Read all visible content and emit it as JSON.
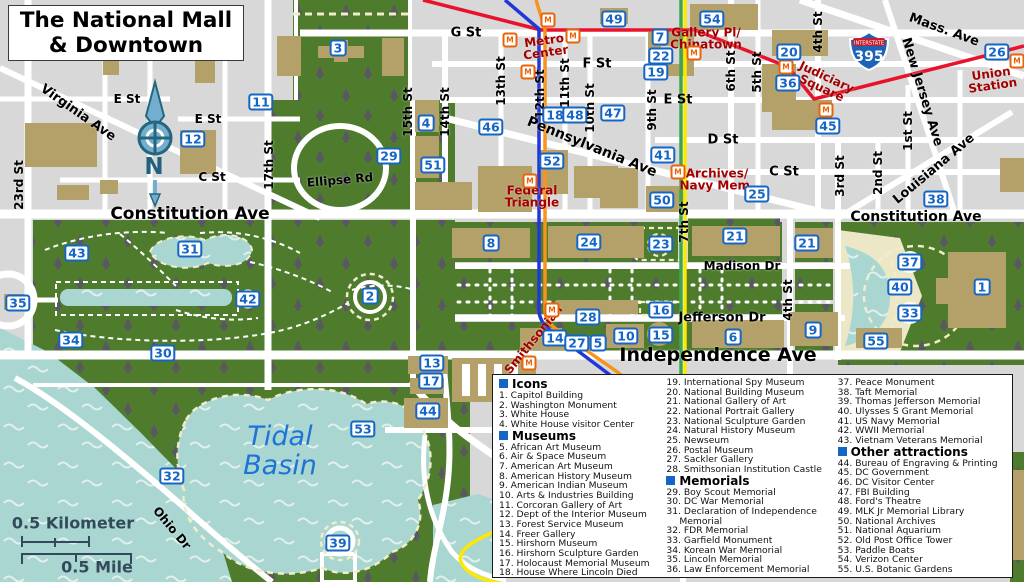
{
  "title": {
    "line1": "The National Mall",
    "line2": "& Downtown"
  },
  "scale": {
    "km": "0.5 Kilometer",
    "mile": "0.5 Mile"
  },
  "interstate": {
    "label": "INTERSTATE",
    "number": "395"
  },
  "compass": {
    "n": "N"
  },
  "colors": {
    "park_green": "#4e7c2c",
    "water": "#a9d6d1",
    "building_tan": "#b3a169",
    "road": "#ffffff",
    "block_gray": "#d8d8d8",
    "plaza_cream": "#ece7c6",
    "marker_blue": "#1565c5",
    "station_red": "#a30000",
    "water_label_blue": "#1b74d6",
    "metro_red": "#e8132b",
    "metro_orange": "#f7941d",
    "metro_blue": "#2138d8",
    "metro_green": "#3aa655",
    "metro_yellow": "#ffe800",
    "scale_slate": "#33495c"
  },
  "map": {
    "water_label": {
      "lines": [
        "Tidal",
        "Basin"
      ]
    },
    "metro_icon_glyph": "M",
    "markers": [
      {
        "n": "1",
        "x": 982,
        "y": 287
      },
      {
        "n": "2",
        "x": 370,
        "y": 296
      },
      {
        "n": "3",
        "x": 338,
        "y": 48
      },
      {
        "n": "4",
        "x": 426,
        "y": 123
      },
      {
        "n": "5",
        "x": 598,
        "y": 343
      },
      {
        "n": "6",
        "x": 733,
        "y": 337
      },
      {
        "n": "7",
        "x": 660,
        "y": 37
      },
      {
        "n": "8",
        "x": 491,
        "y": 243
      },
      {
        "n": "9",
        "x": 813,
        "y": 330
      },
      {
        "n": "10",
        "x": 626,
        "y": 336
      },
      {
        "n": "11",
        "x": 261,
        "y": 102
      },
      {
        "n": "12",
        "x": 193,
        "y": 139
      },
      {
        "n": "13",
        "x": 432,
        "y": 363
      },
      {
        "n": "14",
        "x": 555,
        "y": 338
      },
      {
        "n": "15",
        "x": 661,
        "y": 335
      },
      {
        "n": "16",
        "x": 661,
        "y": 310
      },
      {
        "n": "17",
        "x": 431,
        "y": 381
      },
      {
        "n": "18",
        "x": 555,
        "y": 115
      },
      {
        "n": "19",
        "x": 656,
        "y": 72
      },
      {
        "n": "20",
        "x": 789,
        "y": 52
      },
      {
        "n": "21",
        "x": 735,
        "y": 236
      },
      {
        "n": "21",
        "x": 807,
        "y": 243
      },
      {
        "n": "22",
        "x": 661,
        "y": 56
      },
      {
        "n": "23",
        "x": 661,
        "y": 244
      },
      {
        "n": "24",
        "x": 589,
        "y": 242
      },
      {
        "n": "25",
        "x": 757,
        "y": 194
      },
      {
        "n": "26",
        "x": 997,
        "y": 52
      },
      {
        "n": "27",
        "x": 577,
        "y": 343
      },
      {
        "n": "28",
        "x": 588,
        "y": 317
      },
      {
        "n": "29",
        "x": 389,
        "y": 156
      },
      {
        "n": "30",
        "x": 163,
        "y": 353
      },
      {
        "n": "31",
        "x": 190,
        "y": 249
      },
      {
        "n": "32",
        "x": 172,
        "y": 476
      },
      {
        "n": "33",
        "x": 910,
        "y": 313
      },
      {
        "n": "34",
        "x": 71,
        "y": 340
      },
      {
        "n": "35",
        "x": 18,
        "y": 303
      },
      {
        "n": "36",
        "x": 788,
        "y": 83
      },
      {
        "n": "37",
        "x": 910,
        "y": 262
      },
      {
        "n": "38",
        "x": 936,
        "y": 199
      },
      {
        "n": "39",
        "x": 338,
        "y": 543
      },
      {
        "n": "40",
        "x": 900,
        "y": 287
      },
      {
        "n": "41",
        "x": 663,
        "y": 155
      },
      {
        "n": "42",
        "x": 248,
        "y": 299
      },
      {
        "n": "43",
        "x": 77,
        "y": 253
      },
      {
        "n": "44",
        "x": 428,
        "y": 411
      },
      {
        "n": "45",
        "x": 828,
        "y": 126
      },
      {
        "n": "46",
        "x": 491,
        "y": 127
      },
      {
        "n": "47",
        "x": 613,
        "y": 113
      },
      {
        "n": "48",
        "x": 575,
        "y": 115
      },
      {
        "n": "49",
        "x": 614,
        "y": 19
      },
      {
        "n": "50",
        "x": 662,
        "y": 200
      },
      {
        "n": "51",
        "x": 433,
        "y": 165
      },
      {
        "n": "52",
        "x": 552,
        "y": 161
      },
      {
        "n": "53",
        "x": 363,
        "y": 429
      },
      {
        "n": "54",
        "x": 712,
        "y": 19
      },
      {
        "n": "55",
        "x": 876,
        "y": 341
      }
    ],
    "street_labels": [
      {
        "t": "G St",
        "x": 466,
        "y": 33,
        "r": 0,
        "s": 13
      },
      {
        "t": "F St",
        "x": 597,
        "y": 64,
        "r": 0,
        "s": 13
      },
      {
        "t": "E St",
        "x": 678,
        "y": 100,
        "r": 0,
        "s": 13
      },
      {
        "t": "D St",
        "x": 723,
        "y": 140,
        "r": 0,
        "s": 13
      },
      {
        "t": "C St",
        "x": 784,
        "y": 172,
        "r": 0,
        "s": 13
      },
      {
        "t": "E St",
        "x": 127,
        "y": 99,
        "r": 0,
        "s": 12
      },
      {
        "t": "E St",
        "x": 208,
        "y": 119,
        "r": 0,
        "s": 12
      },
      {
        "t": "C St",
        "x": 212,
        "y": 177,
        "r": 0,
        "s": 12
      },
      {
        "t": "Constitution Ave",
        "x": 190,
        "y": 214,
        "r": 0,
        "s": 17
      },
      {
        "t": "Constitution Ave",
        "x": 916,
        "y": 217,
        "r": 0,
        "s": 14
      },
      {
        "t": "Madison Dr",
        "x": 742,
        "y": 266,
        "r": 0,
        "s": 12
      },
      {
        "t": "Jefferson Dr",
        "x": 722,
        "y": 318,
        "r": 0,
        "s": 13
      },
      {
        "t": "Independence Ave",
        "x": 718,
        "y": 355,
        "r": 0,
        "s": 19
      },
      {
        "t": "Pennsylvania Ave",
        "x": 592,
        "y": 147,
        "r": 22,
        "s": 14
      },
      {
        "t": "Virginia Ave",
        "x": 78,
        "y": 113,
        "r": 35,
        "s": 13
      },
      {
        "t": "Mass. Ave",
        "x": 944,
        "y": 30,
        "r": 20,
        "s": 13
      },
      {
        "t": "New Jersey Ave",
        "x": 922,
        "y": 92,
        "r": 73,
        "s": 13
      },
      {
        "t": "Louisiana Ave",
        "x": 934,
        "y": 169,
        "r": -40,
        "s": 13
      },
      {
        "t": "1st St",
        "x": 908,
        "y": 131,
        "r": -90,
        "s": 12
      },
      {
        "t": "2nd St",
        "x": 878,
        "y": 173,
        "r": -90,
        "s": 12
      },
      {
        "t": "3rd St",
        "x": 840,
        "y": 176,
        "r": -90,
        "s": 12
      },
      {
        "t": "4th St",
        "x": 818,
        "y": 32,
        "r": -90,
        "s": 12
      },
      {
        "t": "5th St",
        "x": 757,
        "y": 72,
        "r": -90,
        "s": 12
      },
      {
        "t": "6th St",
        "x": 731,
        "y": 71,
        "r": -90,
        "s": 12
      },
      {
        "t": "7th St",
        "x": 684,
        "y": 222,
        "r": -90,
        "s": 12
      },
      {
        "t": "9th St",
        "x": 652,
        "y": 110,
        "r": -90,
        "s": 12
      },
      {
        "t": "10th St",
        "x": 590,
        "y": 108,
        "r": -90,
        "s": 12
      },
      {
        "t": "11th St",
        "x": 565,
        "y": 83,
        "r": -90,
        "s": 12
      },
      {
        "t": "12th St",
        "x": 540,
        "y": 94,
        "r": -90,
        "s": 12
      },
      {
        "t": "13th St",
        "x": 501,
        "y": 81,
        "r": -90,
        "s": 12
      },
      {
        "t": "14th St",
        "x": 445,
        "y": 112,
        "r": -90,
        "s": 12
      },
      {
        "t": "15th St",
        "x": 408,
        "y": 112,
        "r": -90,
        "s": 12
      },
      {
        "t": "17th St",
        "x": 269,
        "y": 165,
        "r": -90,
        "s": 12
      },
      {
        "t": "23rd St",
        "x": 19,
        "y": 185,
        "r": -90,
        "s": 12
      },
      {
        "t": "4th St",
        "x": 788,
        "y": 300,
        "r": -90,
        "s": 12
      },
      {
        "t": "Ellipse Rd",
        "x": 340,
        "y": 180,
        "r": -5,
        "s": 12
      },
      {
        "t": "Ohio Dr",
        "x": 172,
        "y": 528,
        "r": 50,
        "s": 12
      }
    ],
    "station_labels": [
      {
        "lines": [
          "Metro",
          "Center"
        ],
        "x": 545,
        "y": 47,
        "r": -8
      },
      {
        "lines": [
          "Gallery Pl/",
          "Chinatown"
        ],
        "x": 706,
        "y": 39,
        "r": 0
      },
      {
        "lines": [
          "Judiciary",
          "Square"
        ],
        "x": 824,
        "y": 83,
        "r": 25
      },
      {
        "lines": [
          "Union",
          "Station"
        ],
        "x": 992,
        "y": 80,
        "r": -8
      },
      {
        "lines": [
          "Federal",
          "Triangle"
        ],
        "x": 532,
        "y": 197,
        "r": 0
      },
      {
        "lines": [
          "Archives/",
          "Navy Mem."
        ],
        "x": 717,
        "y": 180,
        "r": 0
      },
      {
        "lines": [
          "Smithsonian"
        ],
        "x": 534,
        "y": 340,
        "r": -51
      }
    ],
    "metro_icons": [
      {
        "x": 548,
        "y": 20
      },
      {
        "x": 510,
        "y": 40
      },
      {
        "x": 573,
        "y": 36
      },
      {
        "x": 528,
        "y": 72
      },
      {
        "x": 530,
        "y": 181
      },
      {
        "x": 694,
        "y": 53
      },
      {
        "x": 786,
        "y": 67
      },
      {
        "x": 826,
        "y": 110
      },
      {
        "x": 1017,
        "y": 61
      },
      {
        "x": 678,
        "y": 172
      },
      {
        "x": 552,
        "y": 310
      },
      {
        "x": 529,
        "y": 363
      }
    ]
  },
  "legend": {
    "columns": [
      [
        {
          "h": "Icons"
        },
        {
          "i": "1. Capitol Building"
        },
        {
          "i": "2. Washington Monument"
        },
        {
          "i": "3. White House"
        },
        {
          "i": "4. White House visitor Center"
        },
        {
          "h": "Museums"
        },
        {
          "i": "5. African Art Museum"
        },
        {
          "i": "6. Air & Space Museum"
        },
        {
          "i": "7. American Art Museum"
        },
        {
          "i": "8. American History Museum"
        },
        {
          "i": "9. American Indian Museum"
        },
        {
          "i": "10. Arts & Industries Building"
        },
        {
          "i": "11. Corcoran Gallery of Art"
        },
        {
          "i": "12. Dept of the Interior Museum"
        },
        {
          "i": "13. Forest Service Museum"
        },
        {
          "i": "14. Freer Gallery"
        },
        {
          "i": "15. Hirshorn Museum"
        },
        {
          "i": "16. Hirshorn Sculpture Garden"
        },
        {
          "i": "17. Holocaust Memorial Museum"
        },
        {
          "i": "18. House Where Lincoln Died"
        }
      ],
      [
        {
          "i": "19. International Spy Museum"
        },
        {
          "i": "20. National Building Museum"
        },
        {
          "i": "21. National Gallery of Art"
        },
        {
          "i": "22. National Portrait Gallery"
        },
        {
          "i": "23. National Sculpture Garden"
        },
        {
          "i": "24. Natural History Museum"
        },
        {
          "i": "25. Newseum"
        },
        {
          "i": "26. Postal Museum"
        },
        {
          "i": "27. Sackler Gallery"
        },
        {
          "i": "28. Smithsonian Institution Castle"
        },
        {
          "h": "Memorials"
        },
        {
          "i": "29. Boy Scout Memorial"
        },
        {
          "i": "30. DC War Memorial"
        },
        {
          "i": "31. Declaration of Independence Memorial"
        },
        {
          "i": "32. FDR Memorial"
        },
        {
          "i": "33. Garfield Monument"
        },
        {
          "i": "34. Korean War Memorial"
        },
        {
          "i": "35. Lincoln Memorial"
        },
        {
          "i": "36. Law Enforcement Memorial"
        }
      ],
      [
        {
          "i": "37. Peace Monument"
        },
        {
          "i": "38. Taft Memorial"
        },
        {
          "i": "39. Thomas Jefferson Memorial"
        },
        {
          "i": "40. Ulysses S Grant Memorial"
        },
        {
          "i": "41. US Navy Memorial"
        },
        {
          "i": "42. WWII Memorial"
        },
        {
          "i": "43. Vietnam Veterans Memorial"
        },
        {
          "h": "Other attractions"
        },
        {
          "i": "44. Bureau of Engraving & Printing"
        },
        {
          "i": "45. DC Government"
        },
        {
          "i": "46. DC Visitor Center"
        },
        {
          "i": "47. FBI Building"
        },
        {
          "i": "48. Ford's Theatre"
        },
        {
          "i": "49. MLK Jr Memorial Library"
        },
        {
          "i": "50. National Archives"
        },
        {
          "i": "51. National Aquarium"
        },
        {
          "i": "52. Old Post Office Tower"
        },
        {
          "i": "53. Paddle Boats"
        },
        {
          "i": "54. Verizon Center"
        },
        {
          "i": "55. U.S. Botanic Gardens"
        }
      ]
    ]
  }
}
